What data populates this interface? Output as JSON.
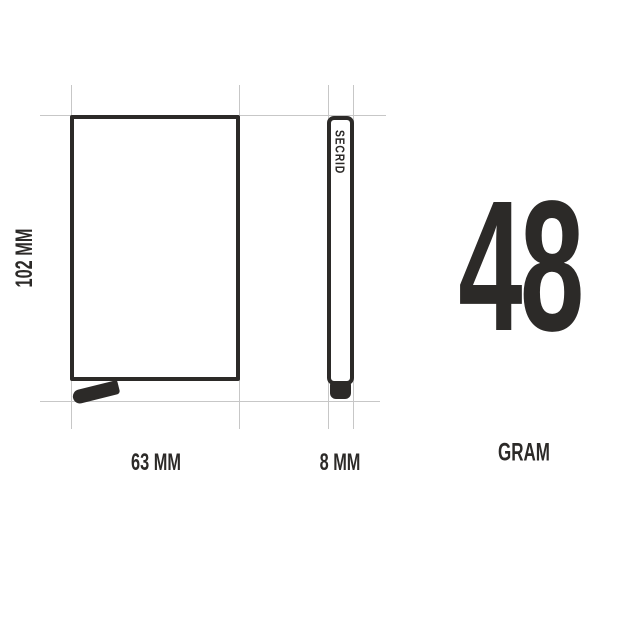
{
  "diagram": {
    "front_view": {
      "height_label": "102 MM",
      "width_label": "63 MM"
    },
    "side_view": {
      "brand_label": "SECRID",
      "width_label": "8 MM"
    },
    "weight": {
      "value": "48",
      "unit_label": "GRAM"
    }
  },
  "colors": {
    "ink": "#2c2a28",
    "guide": "#c7c7c7",
    "background": "#ffffff"
  }
}
